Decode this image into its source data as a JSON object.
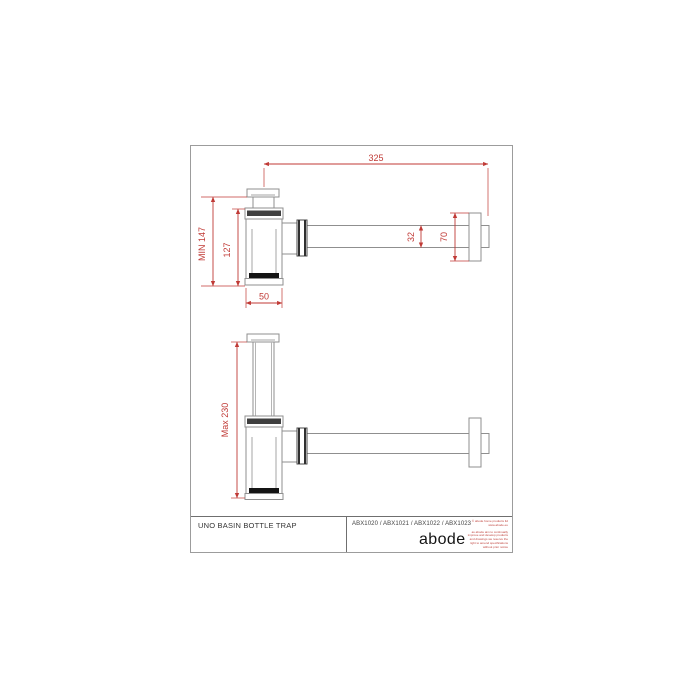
{
  "title_block": {
    "title": "UNO BASIN BOTTLE TRAP",
    "product_codes": "ABX1020 / ABX1021 / ABX1022 / ABX1023",
    "brand_logo": "abode",
    "fine_print_primary": "© abode home products ltd\nwww.abode.eu",
    "fine_print_secondary": "as abode aim to continually\nimprove and develop products\nand drawings we reserve the\nright to amend specifications\nwithout prior notice"
  },
  "dimensions_top_view": {
    "overall_length_mm": "325",
    "min_installed_height": "MIN 147",
    "body_height_mm": "127",
    "body_width_mm": "50",
    "pipe_diameter_mm": "32",
    "wall_flange_mm": "70"
  },
  "dimensions_bottom_view": {
    "max_installed_height": "Max 230"
  },
  "colors": {
    "dimension_red": "#c03a36",
    "line_gray": "#8f8f8f",
    "dark_fill": "#141414"
  }
}
